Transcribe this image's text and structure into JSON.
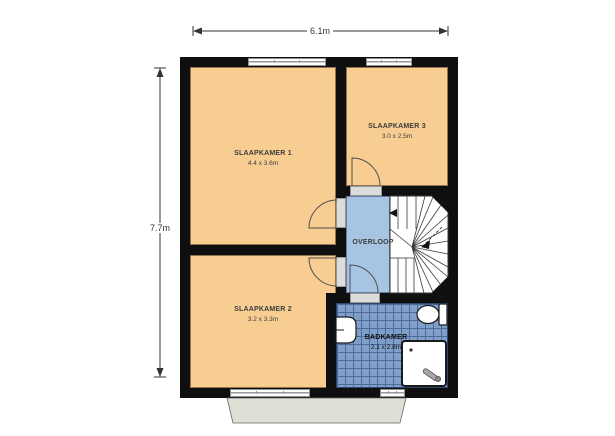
{
  "dimension_labels": {
    "width": "6.1m",
    "height": "7.7m"
  },
  "rooms": {
    "slaapkamer1": {
      "name": "SLAAPKAMER 1",
      "size": "4.4 x 3.6m"
    },
    "slaapkamer2": {
      "name": "SLAAPKAMER 2",
      "size": "3.2 x 3.3m"
    },
    "slaapkamer3": {
      "name": "SLAAPKAMER 3",
      "size": "3.0 x 2.5m"
    },
    "overloop": {
      "name": "OVERLOOP"
    },
    "badkamer": {
      "name": "BADKAMER",
      "size": "2.1 x 2.8m"
    }
  },
  "fixtures": {
    "staircase": "winder-staircase",
    "toilet": "toilet-icon",
    "sink": "wash-basin-icon",
    "shower": "shower-tray-icon",
    "window": "window-symbol",
    "door": "door-swing-symbol",
    "ledge": "roof-ledge"
  },
  "colors": {
    "wall": "#0f0f0f",
    "room_floor": "#F7CD92",
    "landing_floor": "#A7C4E2",
    "bathroom_tile": "#7F9FC8",
    "bathroom_grout": "#4d6b99",
    "ledge": "#DFDFD6"
  }
}
